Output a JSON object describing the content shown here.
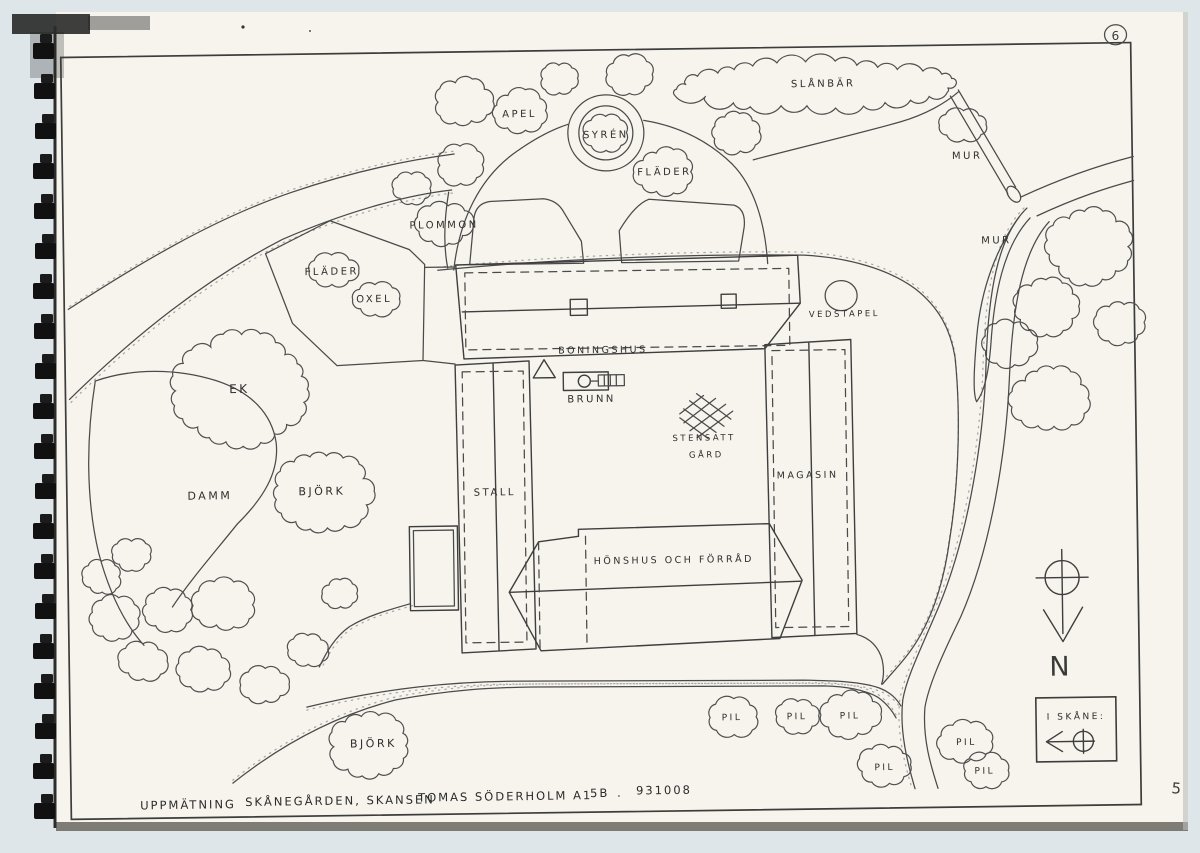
{
  "page": {
    "sheet_number": "6",
    "corner_number": "5",
    "caption_parts": [
      {
        "text": "UPPMÄTNING",
        "x": 135,
        "y": 803
      },
      {
        "text": "SKÅNEGÅRDEN, SKANSEN",
        "x": 240,
        "y": 801
      },
      {
        "text": "TOMAS SÖDERHOLM A1",
        "x": 413,
        "y": 799
      },
      {
        "text": "5B",
        "x": 585,
        "y": 797
      },
      {
        "text": ".",
        "x": 612,
        "y": 797
      },
      {
        "text": "931008",
        "x": 631,
        "y": 795
      }
    ]
  },
  "compass": {
    "north_label": "N"
  },
  "inset": {
    "title": "I SKÅNE:"
  },
  "map": {
    "labels": [
      {
        "text": "APEL",
        "x": 524,
        "y": 116,
        "fs": 10
      },
      {
        "text": "SYRÉN",
        "x": 610,
        "y": 138,
        "fs": 10
      },
      {
        "text": "FLÄDER",
        "x": 668,
        "y": 176,
        "fs": 10
      },
      {
        "text": "PLOMMON",
        "x": 447,
        "y": 226,
        "fs": 10
      },
      {
        "text": "SLÅNBÄR",
        "x": 828,
        "y": 90,
        "fs": 10
      },
      {
        "text": "MUR",
        "x": 971,
        "y": 164,
        "fs": 10
      },
      {
        "text": "MUR",
        "x": 999,
        "y": 249,
        "fs": 10
      },
      {
        "text": "FLÄDER",
        "x": 334,
        "y": 271,
        "fs": 10
      },
      {
        "text": "OXEL",
        "x": 376,
        "y": 299,
        "fs": 10
      },
      {
        "text": "EK",
        "x": 240,
        "y": 388,
        "fs": 12
      },
      {
        "text": "DAMM",
        "x": 209,
        "y": 494,
        "fs": 11
      },
      {
        "text": "BJÖRK",
        "x": 321,
        "y": 491,
        "fs": 11
      },
      {
        "text": "VEDSTAPEL",
        "x": 846,
        "y": 320,
        "fs": 8.5
      },
      {
        "text": "BONINGSHUS",
        "x": 604,
        "y": 353,
        "fs": 9.5
      },
      {
        "text": "BRUNN",
        "x": 592,
        "y": 402,
        "fs": 10
      },
      {
        "text": "STENSATT",
        "x": 704,
        "y": 442,
        "fs": 8.5
      },
      {
        "text": "GÅRD",
        "x": 706,
        "y": 459,
        "fs": 8.5
      },
      {
        "text": "STALL",
        "x": 494,
        "y": 494,
        "fs": 10
      },
      {
        "text": "MAGASIN",
        "x": 807,
        "y": 481,
        "fs": 9.5
      },
      {
        "text": "HÖNSHUS OCH FÖRRÅD",
        "x": 672,
        "y": 564,
        "fs": 9.5
      },
      {
        "text": "BJÖRK",
        "x": 369,
        "y": 744,
        "fs": 11
      },
      {
        "text": "PIL",
        "x": 728,
        "y": 722,
        "fs": 9
      },
      {
        "text": "PIL",
        "x": 793,
        "y": 722,
        "fs": 9
      },
      {
        "text": "PIL",
        "x": 846,
        "y": 722,
        "fs": 9
      },
      {
        "text": "PIL",
        "x": 880,
        "y": 774,
        "fs": 9
      },
      {
        "text": "PIL",
        "x": 962,
        "y": 750,
        "fs": 9
      },
      {
        "text": "PIL",
        "x": 980,
        "y": 779,
        "fs": 9
      }
    ],
    "trees": [
      {
        "x": 468,
        "y": 100,
        "rx": 30,
        "ry": 24
      },
      {
        "x": 525,
        "y": 110,
        "rx": 30,
        "ry": 22
      },
      {
        "x": 564,
        "y": 78,
        "rx": 20,
        "ry": 16
      },
      {
        "x": 634,
        "y": 75,
        "rx": 26,
        "ry": 19
      },
      {
        "x": 740,
        "y": 134,
        "rx": 26,
        "ry": 21
      },
      {
        "x": 610,
        "y": 133,
        "rx": 22,
        "ry": 19
      },
      {
        "x": 668,
        "y": 173,
        "rx": 31,
        "ry": 24
      },
      {
        "x": 464,
        "y": 163,
        "rx": 25,
        "ry": 20
      },
      {
        "x": 415,
        "y": 186,
        "rx": 20,
        "ry": 16
      },
      {
        "x": 447,
        "y": 222,
        "rx": 29,
        "ry": 22
      },
      {
        "x": 818,
        "y": 88,
        "rx": 148,
        "ry": 24
      },
      {
        "x": 968,
        "y": 130,
        "rx": 26,
        "ry": 15
      },
      {
        "x": 334,
        "y": 267,
        "rx": 27,
        "ry": 16
      },
      {
        "x": 377,
        "y": 296,
        "rx": 25,
        "ry": 16
      },
      {
        "x": 243,
        "y": 385,
        "rx": 72,
        "ry": 58
      },
      {
        "x": 322,
        "y": 488,
        "rx": 52,
        "ry": 42
      },
      {
        "x": 112,
        "y": 612,
        "rx": 26,
        "ry": 22
      },
      {
        "x": 164,
        "y": 604,
        "rx": 26,
        "ry": 21
      },
      {
        "x": 222,
        "y": 600,
        "rx": 32,
        "ry": 25
      },
      {
        "x": 140,
        "y": 655,
        "rx": 25,
        "ry": 19
      },
      {
        "x": 200,
        "y": 664,
        "rx": 28,
        "ry": 21
      },
      {
        "x": 262,
        "y": 680,
        "rx": 25,
        "ry": 19
      },
      {
        "x": 305,
        "y": 646,
        "rx": 22,
        "ry": 17
      },
      {
        "x": 100,
        "y": 570,
        "rx": 20,
        "ry": 17
      },
      {
        "x": 130,
        "y": 548,
        "rx": 21,
        "ry": 16
      },
      {
        "x": 338,
        "y": 590,
        "rx": 18,
        "ry": 14
      },
      {
        "x": 366,
        "y": 743,
        "rx": 43,
        "ry": 34
      },
      {
        "x": 730,
        "y": 719,
        "rx": 26,
        "ry": 19
      },
      {
        "x": 794,
        "y": 719,
        "rx": 23,
        "ry": 17
      },
      {
        "x": 846,
        "y": 718,
        "rx": 31,
        "ry": 24
      },
      {
        "x": 880,
        "y": 769,
        "rx": 27,
        "ry": 20
      },
      {
        "x": 962,
        "y": 747,
        "rx": 29,
        "ry": 21
      },
      {
        "x": 981,
        "y": 776,
        "rx": 25,
        "ry": 18
      },
      {
        "x": 1092,
        "y": 254,
        "rx": 45,
        "ry": 38
      },
      {
        "x": 1048,
        "y": 313,
        "rx": 35,
        "ry": 29
      },
      {
        "x": 1011,
        "y": 349,
        "rx": 27,
        "ry": 23
      },
      {
        "x": 1050,
        "y": 405,
        "rx": 39,
        "ry": 33
      },
      {
        "x": 1122,
        "y": 330,
        "rx": 26,
        "ry": 22
      }
    ]
  }
}
